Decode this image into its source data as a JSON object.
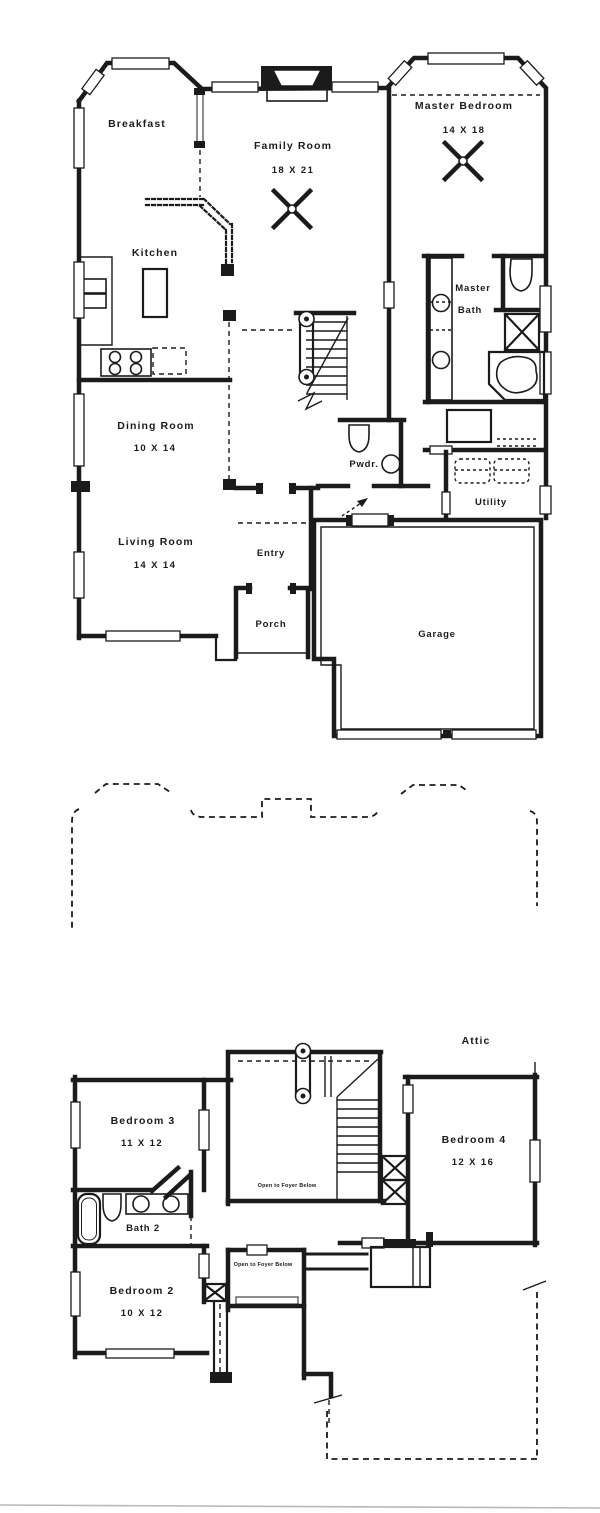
{
  "colors": {
    "paper": "#ffffff",
    "ink": "#1b1b1b",
    "scan_line": "#b9b9b9"
  },
  "floor1": {
    "breakfast": {
      "label": "Breakfast"
    },
    "family_room": {
      "label": "Family Room",
      "dims": "18 X 21"
    },
    "master_bedroom": {
      "label": "Master Bedroom",
      "dims": "14 X 18"
    },
    "kitchen": {
      "label": "Kitchen"
    },
    "master_bath": {
      "line1": "Master",
      "line2": "Bath"
    },
    "dining_room": {
      "label": "Dining Room",
      "dims": "10 X 14"
    },
    "living_room": {
      "label": "Living Room",
      "dims": "14 X 14"
    },
    "powder": {
      "label": "Pwdr."
    },
    "utility": {
      "label": "Utility"
    },
    "entry": {
      "label": "Entry"
    },
    "porch": {
      "label": "Porch"
    },
    "garage": {
      "label": "Garage"
    }
  },
  "floor2": {
    "attic": {
      "label": "Attic"
    },
    "bedroom3": {
      "label": "Bedroom 3",
      "dims": "11 X 12"
    },
    "bedroom4": {
      "label": "Bedroom 4",
      "dims": "12 X 16"
    },
    "bath2": {
      "label": "Bath 2"
    },
    "bedroom2": {
      "label": "Bedroom 2",
      "dims": "10 X 12"
    },
    "open_to_foyer_1": {
      "label": "Open to Foyer Below"
    },
    "open_to_foyer_2": {
      "label": "Open to Foyer Below"
    }
  }
}
